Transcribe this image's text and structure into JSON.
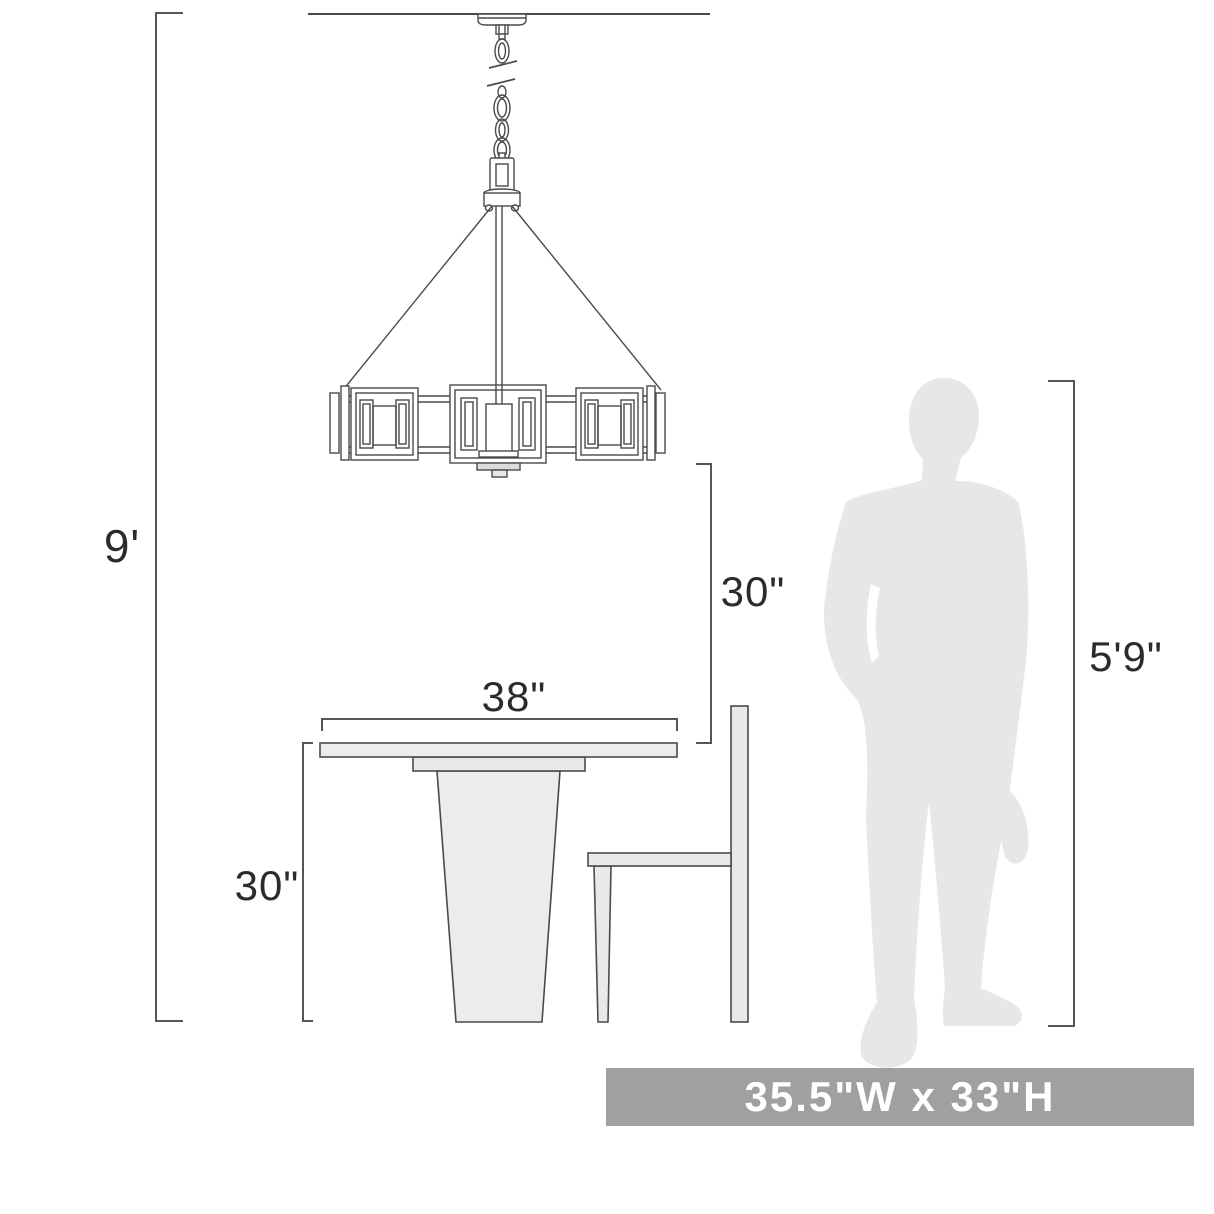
{
  "diagram": {
    "type": "product-dimension-diagram",
    "subject": "chandelier over dining table with chair and human figure for scale",
    "labels": {
      "overall_height": "9'",
      "fixture_to_table": "30\"",
      "table_width": "38\"",
      "table_height": "30\"",
      "person_height": "5'9\""
    },
    "banner": {
      "text": "35.5\"W x 33\"H"
    },
    "colors": {
      "line": "#4a4a4a",
      "bracket": "#565656",
      "label_text": "#2b2b2b",
      "furniture_fill": "#ececec",
      "silhouette_fill": "#e7e7e7",
      "banner_bg": "#a0a0a2",
      "banner_text": "#ffffff",
      "background": "#ffffff"
    }
  }
}
